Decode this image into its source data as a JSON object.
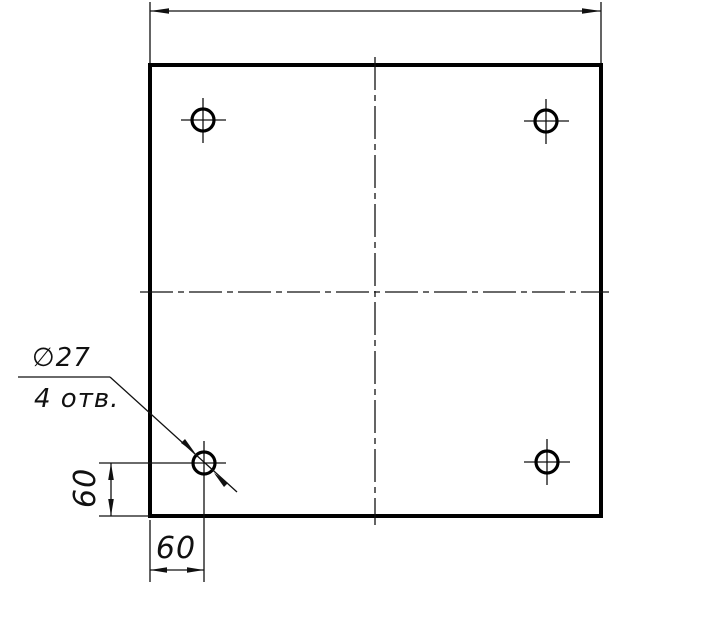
{
  "drawing": {
    "background_color": "#ffffff",
    "line_color": "#111111",
    "annotations": {
      "hole_diameter_label": "∅27",
      "hole_count_label": "4 отв.",
      "vertical_offset_label": "60",
      "horizontal_offset_label": "60"
    },
    "described_content": {
      "view": "square plate, front view",
      "holes": 4,
      "hole_diameter": 27,
      "hole_edge_offset_x": 60,
      "hole_edge_offset_y": 60,
      "top_width_dimension_label": ""
    }
  }
}
